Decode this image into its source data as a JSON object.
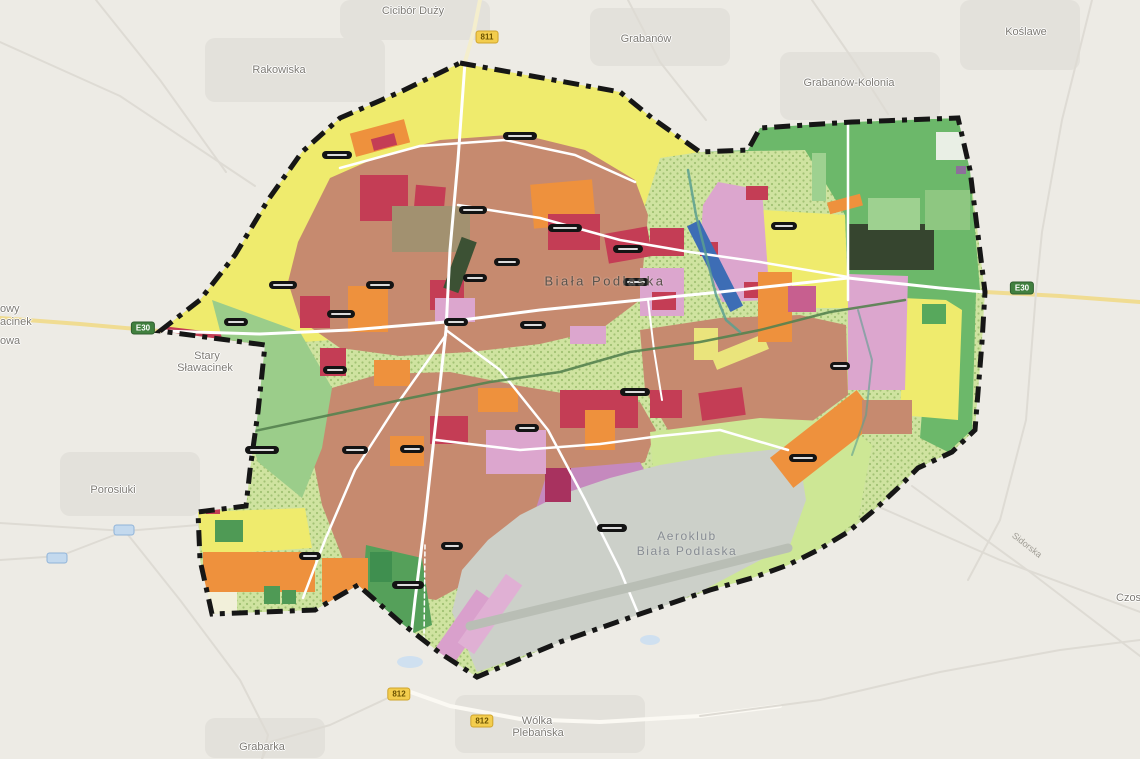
{
  "map": {
    "city_label": "Biała Podlaska",
    "airfield": {
      "line1": "Aeroklub",
      "line2": "Biała Podlaska"
    },
    "street_label": {
      "text": "Sidorska",
      "x": 1027,
      "y": 545
    },
    "colors": {
      "bg": "#edebe5",
      "builtup": "#e3e1db",
      "pond": "#cfe0f0",
      "yellow": "#efeb6d",
      "green": "#6cb86a",
      "green_light": "#9ed190",
      "forest_dark": "#36452f",
      "lime_bg": "#cfe3a0",
      "lime_dot": "#a2c274",
      "lime": "#cde795",
      "salmon": "#c68a6f",
      "red": "#c43d55",
      "orange": "#ee913d",
      "pink": "#dca6ce",
      "violet": "#c589be",
      "magenta": "#a8325f",
      "airfield_gray": "#ccd0c9",
      "runway": "#b9beb5",
      "blue": "#3d6db5",
      "river": "#55824f",
      "river2": "#5b9f8f",
      "road_white": "#ffffff",
      "road_yellow": "#f0dc92",
      "road_faint": "#dedbd4",
      "boundary": "#161616"
    },
    "boundary_points": "460,63 620,92 652,118 700,152 748,150 760,128 852,122 958,118 970,170 985,292 982,342 975,430 952,452 918,468 898,488 872,512 848,532 818,550 788,565 752,578 710,590 640,614 560,642 477,677 440,653 400,622 358,585 315,610 212,614 200,560 198,512 246,506 250,470 258,412 265,345 160,331 200,300 235,255 268,200 302,152 340,118 400,92",
    "regions": [
      {
        "name": "yellow-north",
        "fill": "yellow",
        "pts": "160,331 200,300 235,255 268,200 302,152 340,118 400,92 460,63 620,92 652,118 700,152 660,158 645,205 635,262 620,302 560,332 430,346 330,340 265,345"
      },
      {
        "name": "red-strip-west",
        "fill": "red",
        "pts": "162,326 262,338 258,360 172,342"
      },
      {
        "name": "green-northeast",
        "fill": "green",
        "pts": "700,152 748,148 760,126 852,122 958,118 970,170 980,290 940,304 848,300 845,215 805,150"
      },
      {
        "name": "green-east-strip",
        "fill": "green",
        "pts": "938,300 976,292 972,430 948,452 920,438 926,360"
      },
      {
        "name": "yellow-east",
        "fill": "yellow",
        "pts": "902,298 946,300 962,310 958,420 900,415 904,330"
      },
      {
        "name": "pink-east",
        "fill": "pink",
        "pts": "848,274 908,276 905,390 848,390"
      },
      {
        "name": "yellow-ne-col",
        "fill": "yellow",
        "pts": "763,210 845,215 848,308 790,308 763,272"
      },
      {
        "name": "urban-north",
        "fill": "salmon",
        "pts": "298,242 330,178 380,156 440,140 520,134 585,150 635,180 648,215 640,300 600,330 540,344 470,352 400,356 340,348 300,320 288,282"
      },
      {
        "name": "pink-ne",
        "fill": "pink",
        "pts": "718,182 762,190 770,300 722,302 700,250 703,205"
      },
      {
        "name": "urban-arm-east",
        "fill": "salmon",
        "pts": "640,330 720,318 800,315 846,325 848,395 800,430 755,458 726,470 698,462 668,430 645,390"
      },
      {
        "name": "urban-south",
        "fill": "salmon",
        "pts": "318,392 380,374 450,372 520,386 580,396 640,402 656,430 645,462 600,478 556,498 515,538 480,576 436,600 385,592 344,562 322,505 310,444"
      },
      {
        "name": "green-west",
        "fill": "#9bcd8a",
        "pts": "212,300 300,332 332,388 322,448 302,498 258,462 238,400"
      },
      {
        "name": "lime-southeast",
        "fill": "lime",
        "pts": "650,432 760,418 845,422 872,445 858,520 820,548 782,583 742,598 700,588 672,552 655,498"
      },
      {
        "name": "violet-south",
        "fill": "violet",
        "pts": "548,470 640,462 660,500 652,556 618,592 560,628 536,580 534,515"
      },
      {
        "name": "airfield",
        "fill": "airfield_gray",
        "pts": "452,612 477,672 560,643 640,615 700,592 745,568 790,545 806,500 800,462 788,448 720,455 660,465 610,478 560,495 520,515 488,540 462,570"
      },
      {
        "name": "green-southwest",
        "fill": "#55a05a",
        "pts": "366,545 422,558 432,625 398,640 362,600"
      },
      {
        "name": "bulge-yellow",
        "fill": "yellow",
        "pts": "198,512 305,508 312,548 250,552 202,552"
      }
    ],
    "patches": [
      [
        352,
        126,
        56,
        24,
        "orange",
        -15
      ],
      [
        372,
        136,
        24,
        12,
        "red",
        -15
      ],
      [
        360,
        175,
        48,
        46,
        "red",
        0
      ],
      [
        414,
        186,
        30,
        44,
        "red",
        5
      ],
      [
        392,
        206,
        78,
        46,
        "#a29170",
        0
      ],
      [
        532,
        182,
        62,
        44,
        "orange",
        -5
      ],
      [
        548,
        214,
        52,
        36,
        "red",
        0
      ],
      [
        606,
        230,
        44,
        30,
        "red",
        -10
      ],
      [
        650,
        228,
        34,
        28,
        "red",
        0
      ],
      [
        430,
        280,
        34,
        30,
        "red",
        0
      ],
      [
        300,
        296,
        30,
        32,
        "red",
        0
      ],
      [
        348,
        286,
        40,
        46,
        "orange",
        0
      ],
      [
        452,
        238,
        16,
        54,
        "#3c5134",
        20
      ],
      [
        320,
        348,
        26,
        28,
        "red",
        0
      ],
      [
        435,
        298,
        40,
        24,
        "pink",
        0
      ],
      [
        374,
        360,
        36,
        26,
        "orange",
        0
      ],
      [
        560,
        390,
        78,
        38,
        "red",
        0
      ],
      [
        585,
        410,
        30,
        40,
        "orange",
        0
      ],
      [
        430,
        416,
        38,
        28,
        "red",
        0
      ],
      [
        390,
        436,
        34,
        30,
        "orange",
        0
      ],
      [
        478,
        388,
        40,
        24,
        "orange",
        0
      ],
      [
        650,
        390,
        32,
        28,
        "red",
        0
      ],
      [
        700,
        390,
        44,
        28,
        "red",
        -8
      ],
      [
        770,
        420,
        110,
        38,
        "orange",
        -38
      ],
      [
        545,
        468,
        26,
        34,
        "magenta",
        0
      ],
      [
        486,
        430,
        60,
        44,
        "pink",
        0
      ],
      [
        694,
        328,
        24,
        32,
        "#eae47c",
        0
      ],
      [
        712,
        344,
        56,
        16,
        "#eae47c",
        -22
      ],
      [
        370,
        552,
        22,
        30,
        "#3f8f4f",
        0
      ],
      [
        922,
        304,
        24,
        20,
        "#57a85c",
        0
      ],
      [
        848,
        224,
        86,
        46,
        "forest_dark",
        0
      ],
      [
        936,
        132,
        30,
        28,
        "#e9efe5",
        0
      ],
      [
        956,
        166,
        10,
        8,
        "#8d6f9b",
        0
      ],
      [
        195,
        582,
        42,
        32,
        "#f2f0da",
        0
      ],
      [
        203,
        552,
        112,
        40,
        "orange",
        0
      ],
      [
        215,
        520,
        28,
        22,
        "#4f9a55",
        0
      ],
      [
        264,
        586,
        16,
        18,
        "#4f9a55",
        0
      ],
      [
        282,
        590,
        14,
        14,
        "#4f9a55",
        0
      ],
      [
        206,
        507,
        14,
        7,
        "red",
        0
      ],
      [
        746,
        186,
        22,
        14,
        "red",
        0
      ],
      [
        700,
        242,
        18,
        14,
        "red",
        0
      ],
      [
        744,
        282,
        20,
        16,
        "red",
        0
      ],
      [
        758,
        272,
        34,
        70,
        "orange",
        0
      ],
      [
        788,
        286,
        28,
        26,
        "#c75f8f",
        0
      ],
      [
        640,
        268,
        44,
        48,
        "pink",
        0
      ],
      [
        652,
        292,
        24,
        18,
        "red",
        0
      ],
      [
        812,
        153,
        14,
        48,
        "green_light",
        0
      ],
      [
        868,
        198,
        52,
        32,
        "green_light",
        0
      ],
      [
        925,
        190,
        45,
        40,
        "#8ec781",
        0
      ],
      [
        448,
        588,
        24,
        92,
        "#d9a0cc",
        35
      ],
      [
        480,
        572,
        20,
        84,
        "#e0b0d4",
        35
      ],
      [
        708,
        218,
        14,
        96,
        "blue",
        -27
      ],
      [
        828,
        198,
        34,
        12,
        "orange",
        -15
      ],
      [
        322,
        558,
        46,
        44,
        "orange",
        0
      ],
      [
        862,
        400,
        50,
        34,
        "salmon",
        0
      ],
      [
        570,
        326,
        36,
        18,
        "pink",
        0
      ]
    ],
    "builtup_blobs": [
      [
        205,
        38,
        180,
        64
      ],
      [
        340,
        0,
        150,
        40
      ],
      [
        590,
        8,
        140,
        58
      ],
      [
        780,
        52,
        160,
        68
      ],
      [
        60,
        452,
        140,
        64
      ],
      [
        455,
        695,
        190,
        58
      ],
      [
        205,
        718,
        120,
        40
      ],
      [
        960,
        0,
        120,
        70
      ]
    ],
    "ponds": [
      [
        410,
        662,
        26,
        12
      ],
      [
        650,
        640,
        20,
        10
      ]
    ],
    "roads_outside": [
      {
        "pts": "0,318 80,324 160,331",
        "c": "road_yellow",
        "w": 4
      },
      {
        "pts": "985,292 1060,296 1140,302",
        "c": "road_yellow",
        "w": 4
      },
      {
        "pts": "480,0 474,30 465,62",
        "c": "#f4eecd",
        "w": 4
      },
      {
        "pts": "405,690 450,706 520,719 600,722 700,716 780,706",
        "c": "#fbf9f3",
        "w": 4
      },
      {
        "pts": "0,42 120,96 255,186",
        "c": "road_faint",
        "w": 2
      },
      {
        "pts": "96,0 160,80 226,172",
        "c": "road_faint",
        "w": 2
      },
      {
        "pts": "628,0 660,62 706,120",
        "c": "road_faint",
        "w": 2
      },
      {
        "pts": "812,0 856,64 888,114",
        "c": "road_faint",
        "w": 2
      },
      {
        "pts": "1092,0 1062,120 1042,232 1036,292",
        "c": "road_faint",
        "w": 2
      },
      {
        "pts": "1036,292 1026,420 1000,520 968,580",
        "c": "road_faint",
        "w": 2
      },
      {
        "pts": "0,523 125,531 235,522 330,508",
        "c": "road_faint",
        "w": 2
      },
      {
        "pts": "125,531 180,600 240,680 268,735 262,759",
        "c": "road_faint",
        "w": 2
      },
      {
        "pts": "0,560 60,556 125,531",
        "c": "road_faint",
        "w": 2
      },
      {
        "pts": "405,690 330,725 270,742 262,759",
        "c": "road_faint",
        "w": 2
      },
      {
        "pts": "870,503 1000,560 1140,612",
        "c": "road_faint",
        "w": 2
      },
      {
        "pts": "912,486 1030,572 1140,656",
        "c": "road_faint",
        "w": 2
      },
      {
        "pts": "700,716 820,700 940,672 1060,650 1140,640",
        "c": "road_faint",
        "w": 2
      }
    ],
    "roads_inside": [
      {
        "pts": "465,62 458,160 450,250 446,330 436,420 425,520 415,600 405,690",
        "c": "road_white",
        "w": 3
      },
      {
        "pts": "162,331 260,334 350,330 446,322 540,310 640,300 720,292 848,278 940,288 985,292",
        "c": "road_white",
        "w": 3
      },
      {
        "pts": "446,330 500,370 548,430 585,500 620,570 640,618",
        "c": "road_white",
        "w": 2.5
      },
      {
        "pts": "446,335 400,400 355,470 325,540 303,598",
        "c": "road_white",
        "w": 2.5
      },
      {
        "pts": "436,440 520,450 600,444 660,436 720,430 788,450",
        "c": "road_white",
        "w": 2.5
      },
      {
        "pts": "458,205 540,218 620,240 690,252 760,262 848,277",
        "c": "road_white",
        "w": 2.5
      },
      {
        "pts": "340,168 420,146 505,140 575,155 635,182",
        "c": "road_white",
        "w": 2.5
      },
      {
        "pts": "848,124 848,300",
        "c": "road_white",
        "w": 2.5
      },
      {
        "pts": "648,300 654,350 662,400",
        "c": "road_white",
        "w": 2
      },
      {
        "pts": "470,626 640,585 788,548",
        "c": "runway",
        "w": 9
      },
      {
        "pts": "425,545 424,640",
        "c": "road_white",
        "w": 1.5,
        "dash": "4 3"
      }
    ],
    "rivers": [
      {
        "pts": "250,432 330,415 410,398 490,382 560,372 630,352 700,342 760,330 830,312 905,300",
        "c": "river",
        "w": 2.5,
        "op": 0.9
      },
      {
        "pts": "688,170 696,215 706,255 716,295 726,320 740,332",
        "c": "river2",
        "w": 2.5,
        "op": 0.85
      },
      {
        "pts": "858,310 872,360 866,415 852,455",
        "c": "river2",
        "w": 2,
        "op": 0.6
      }
    ],
    "place_labels": [
      {
        "text": "Cicibór Duży",
        "x": 413,
        "y": 11
      },
      {
        "text": "Rakowiska",
        "x": 279,
        "y": 70
      },
      {
        "text": "Grabanów",
        "x": 646,
        "y": 39
      },
      {
        "text": "Koślawe",
        "x": 1026,
        "y": 32
      },
      {
        "text": "Grabanów-Kolonia",
        "x": 849,
        "y": 83
      },
      {
        "text": "Stary",
        "x": 207,
        "y": 356
      },
      {
        "text": "Sławacinek",
        "x": 205,
        "y": 368
      },
      {
        "text": "Porosiuki",
        "x": 113,
        "y": 490
      },
      {
        "text": "Grabarka",
        "x": 262,
        "y": 747
      },
      {
        "text": "Wólka",
        "x": 537,
        "y": 721
      },
      {
        "text": "Plebańska",
        "x": 538,
        "y": 733
      },
      {
        "text": "owy",
        "x": 0,
        "y": 309,
        "anchor": "left"
      },
      {
        "text": "acinek",
        "x": 0,
        "y": 322,
        "anchor": "left"
      },
      {
        "text": "owa",
        "x": 0,
        "y": 341,
        "anchor": "left"
      },
      {
        "text": "Czos",
        "x": 1116,
        "y": 598,
        "anchor": "left"
      }
    ],
    "road_badges": [
      {
        "text": "811",
        "x": 487,
        "y": 37,
        "type": "yellow"
      },
      {
        "text": "812",
        "x": 399,
        "y": 694,
        "type": "yellow"
      },
      {
        "text": "812",
        "x": 482,
        "y": 721,
        "type": "yellow"
      },
      {
        "text": "E30",
        "x": 1022,
        "y": 288,
        "type": "green"
      },
      {
        "text": "E30",
        "x": 143,
        "y": 328,
        "type": "green"
      }
    ],
    "mini_badges": [
      [
        124,
        530
      ],
      [
        57,
        558
      ]
    ],
    "zone_pills": [
      [
        337,
        155,
        30
      ],
      [
        520,
        136,
        34
      ],
      [
        473,
        210,
        28
      ],
      [
        565,
        228,
        34
      ],
      [
        628,
        249,
        30
      ],
      [
        507,
        262,
        26
      ],
      [
        475,
        278,
        24
      ],
      [
        380,
        285,
        28
      ],
      [
        283,
        285,
        28
      ],
      [
        236,
        322,
        24
      ],
      [
        341,
        314,
        28
      ],
      [
        456,
        322,
        24
      ],
      [
        533,
        325,
        26
      ],
      [
        636,
        282,
        26
      ],
      [
        784,
        226,
        26
      ],
      [
        840,
        366,
        20
      ],
      [
        335,
        370,
        24
      ],
      [
        262,
        450,
        34
      ],
      [
        355,
        450,
        26
      ],
      [
        412,
        449,
        24
      ],
      [
        527,
        428,
        24
      ],
      [
        635,
        392,
        30
      ],
      [
        803,
        458,
        28
      ],
      [
        612,
        528,
        30
      ],
      [
        408,
        585,
        32
      ],
      [
        452,
        546,
        22
      ],
      [
        310,
        556,
        22
      ]
    ]
  }
}
